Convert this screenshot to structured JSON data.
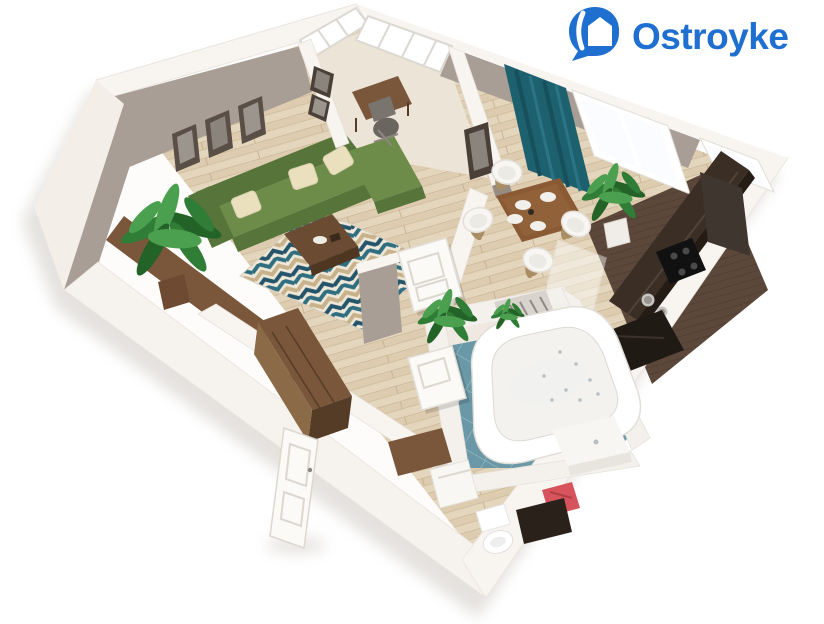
{
  "page": {
    "background": "#ffffff"
  },
  "logo": {
    "brand": "Ostroyke",
    "icon": "house-pin",
    "color": "#1e6fd0"
  },
  "scene": {
    "kind": "3d-floor-plan-render",
    "view": "isometric",
    "rooms": [
      {
        "name": "living-room",
        "items": [
          "corner-sofa",
          "throw-pillows",
          "coffee-table",
          "chevron-rug",
          "sideboard",
          "potted-plant",
          "picture-frames"
        ]
      },
      {
        "name": "balcony",
        "items": [
          "panoramic-glazing",
          "desk",
          "desk-chair"
        ]
      },
      {
        "name": "dining-area",
        "items": [
          "dining-table",
          "plates",
          "four-chairs",
          "teal-curtain",
          "windows",
          "potted-plant",
          "wall-frame"
        ]
      },
      {
        "name": "kitchen",
        "items": [
          "counter",
          "cooktop",
          "sink",
          "tall-cabinet",
          "floor-mat",
          "glass-partition"
        ]
      },
      {
        "name": "hallway",
        "items": [
          "white-doors",
          "potted-plant",
          "wall-stub"
        ]
      },
      {
        "name": "bathroom",
        "items": [
          "corner-jacuzzi-tub",
          "toilet",
          "vanity",
          "basin-counter",
          "radiator",
          "red-towel",
          "small-plant",
          "washing-machine"
        ]
      },
      {
        "name": "entry",
        "items": [
          "wardrobe",
          "bench",
          "entrance-door"
        ]
      }
    ]
  },
  "colors": {
    "brand_blue": "#1e6fd0",
    "wall_top": "#f8f5f1",
    "wall_face": "#a89e95",
    "wall_face_dark": "#968c83",
    "exterior": "#f3eee8",
    "floor_wood": "#e4d6bc",
    "floor_wood_dark": "#d5c2a2",
    "plank_line": "#c3ac8a",
    "balcony_floor": "#ece4d6",
    "kitchen_floor": "#5c473b",
    "kitchen_floor_line": "#49372c",
    "counter_dark": "#3a2e25",
    "counter_edge": "#241c15",
    "appliance_black": "#111111",
    "bath_tile": "#6a98a6",
    "bath_tile_line": "#a6c6cf",
    "bath_wall": "#f0e9e2",
    "sofa_green": "#6d8c4a",
    "sofa_green_dark": "#57743a",
    "pillow_cream": "#eae0bd",
    "rug_cream": "#efe8d8",
    "rug_teal": "#2f6f80",
    "rug_navy": "#24556b",
    "rug_tan": "#c8b28b",
    "wood_brown": "#7a563a",
    "wood_dark": "#553c26",
    "wood_mid": "#8a6a47",
    "curtain_teal": "#1d606e",
    "curtain_fold": "#174f5c",
    "plant_dark": "#236328",
    "plant_mid": "#2f7d36",
    "plant_light": "#4aa04e",
    "white_furn": "#f7f6f2",
    "furn_stroke": "#e3dfd8",
    "accent_red": "#d8545c",
    "steel": "#c7c5c1",
    "shadow_c": "#cfcac4"
  }
}
